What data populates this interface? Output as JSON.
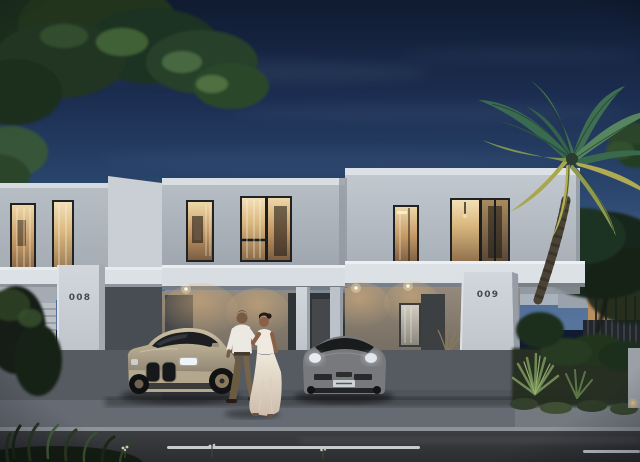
{
  "meta": {
    "description": "Dusk architectural rendering of modern white duplex villas with carports, a couple walking on the driveway, a beige sports coupe and a grey sports car, palm tree and landscaping",
    "time_of_day": "dusk"
  },
  "houses": {
    "left_unit": {
      "number": "008"
    },
    "right_unit": {
      "number": "009"
    }
  },
  "vehicles": [
    {
      "name": "beige-sports-coupe",
      "body_color": "#b3a78e",
      "location": "left carport"
    },
    {
      "name": "grey-sports-car",
      "body_color": "#77797c",
      "location": "right carport"
    }
  ],
  "people": [
    {
      "name": "man",
      "clothing": "white shirt, olive-brown trousers"
    },
    {
      "name": "woman",
      "clothing": "cream sleeveless top, long flowing cream skirt"
    }
  ],
  "vegetation": [
    "overhanging-tree-branches",
    "palm-tree",
    "background-tree",
    "shrubs",
    "agave",
    "foreground-grasses"
  ],
  "lighting": [
    "warm-interior-window-glow",
    "carport-downlights",
    "keypad-light"
  ],
  "colors": {
    "sky_top": "#101b31",
    "sky_mid": "#2b476f",
    "sky_horizon": "#56749c",
    "horizon_glow": "#8a7a88",
    "wall_light": "#c3cad1",
    "fascia": "#dce1e6",
    "window_glow": "#d9a96e",
    "carport_wall": "#8d8275",
    "pavement": "#666b73",
    "road": "#35373b",
    "lane_marking": "#c6cbd0",
    "palm_frond": "#3f6e52",
    "palm_frond_lit": "#b5ae55",
    "foliage_dark": "#1f3322",
    "car_beige": "#b3a78e",
    "car_grey": "#77797c"
  }
}
